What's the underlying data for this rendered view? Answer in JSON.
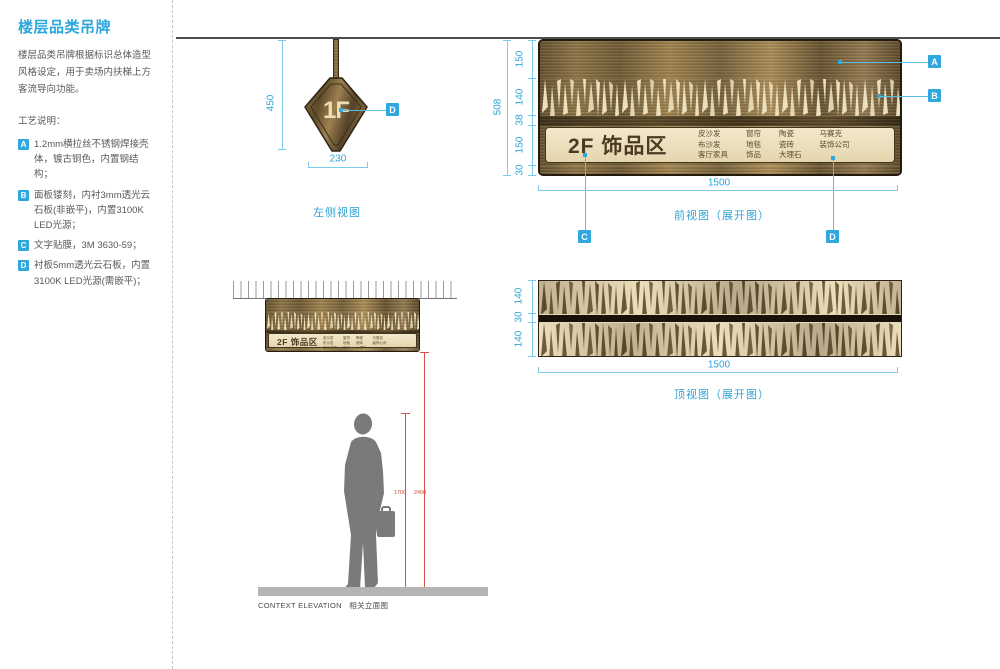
{
  "colors": {
    "accent_blue": "#2fa8dd",
    "dimension_blue": "#7ccbe9",
    "bronze": "#7a6138",
    "cream_panel": "#ead9b5",
    "measure_red": "#d9534a"
  },
  "sidebar": {
    "title": "楼层品类吊牌",
    "description": "楼层品类吊牌根据标识总体造型风格设定，用于卖场内扶梯上方客流导向功能。",
    "process_heading": "工艺说明：",
    "notes": [
      {
        "key": "A",
        "text": "1.2mm横拉丝不锈钢焊接壳体，镀古铜色，内置钢结构；"
      },
      {
        "key": "B",
        "text": "面板镂刻，内衬3mm透光云石板(非嵌平)，内置3100K LED光源；"
      },
      {
        "key": "C",
        "text": "文字贴膜，3M 3630-59；"
      },
      {
        "key": "D",
        "text": "衬板5mm透光云石板，内置3100K LED光源(需嵌平)；"
      }
    ]
  },
  "side_view": {
    "caption": "左侧视图",
    "sign_text": "1F",
    "dim_height": "450",
    "dim_width": "230",
    "callout": "D"
  },
  "front_view": {
    "caption": "前视图（展开图）",
    "sign_title": "2F 饰品区",
    "categories": [
      [
        "皮沙发",
        "布沙发",
        "客厅家具"
      ],
      [
        "窗帘",
        "地毯",
        "饰品"
      ],
      [
        "陶瓷",
        "瓷砖",
        "大理石"
      ],
      [
        "马赛克",
        "装饰公司"
      ]
    ],
    "dim_total": "508",
    "dim_segments": [
      "150",
      "140",
      "38",
      "150",
      "30"
    ],
    "dim_width": "1500",
    "callouts": [
      "A",
      "B",
      "C",
      "D"
    ]
  },
  "top_view": {
    "caption": "顶视图（展开图）",
    "dim_segments": [
      "140",
      "30",
      "140"
    ],
    "dim_width": "1500"
  },
  "context": {
    "caption_en": "CONTEXT ELEVATION",
    "caption_zh": "相关立面图",
    "sign_title": "2F 饰品区",
    "height_person": "1700",
    "height_sign": "2400"
  }
}
